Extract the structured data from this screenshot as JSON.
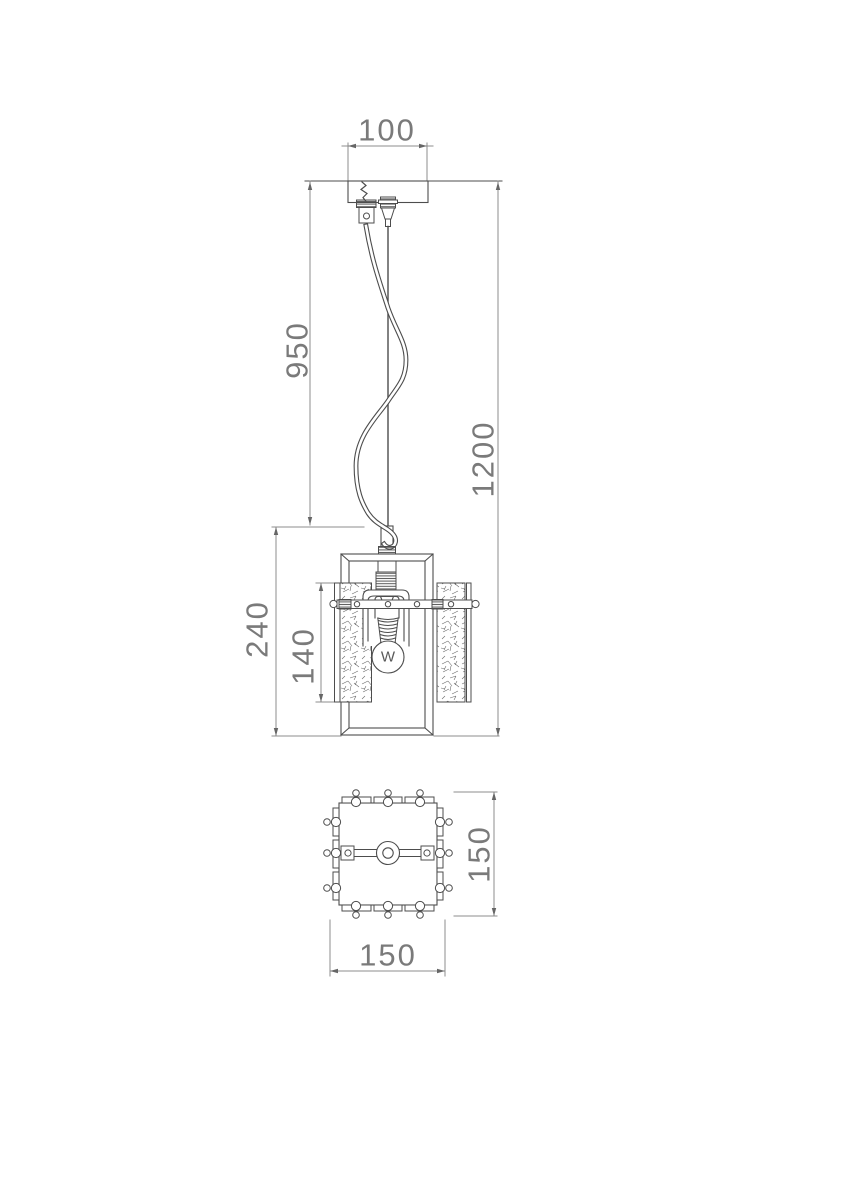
{
  "drawing": {
    "type": "technical-drawing-pendant-lamp",
    "dims": {
      "canopy_width": "100",
      "suspension_length": "950",
      "overall_height": "1200",
      "body_height": "240",
      "glass_panel_height": "140",
      "plate_depth": "150",
      "plate_width": "150"
    },
    "bulb": {
      "label": "W"
    },
    "colors": {
      "line": "#4d4d4d",
      "dimension_line": "#8c8c8c",
      "dimension_text": "#7a7a7a",
      "background": "#ffffff"
    }
  }
}
